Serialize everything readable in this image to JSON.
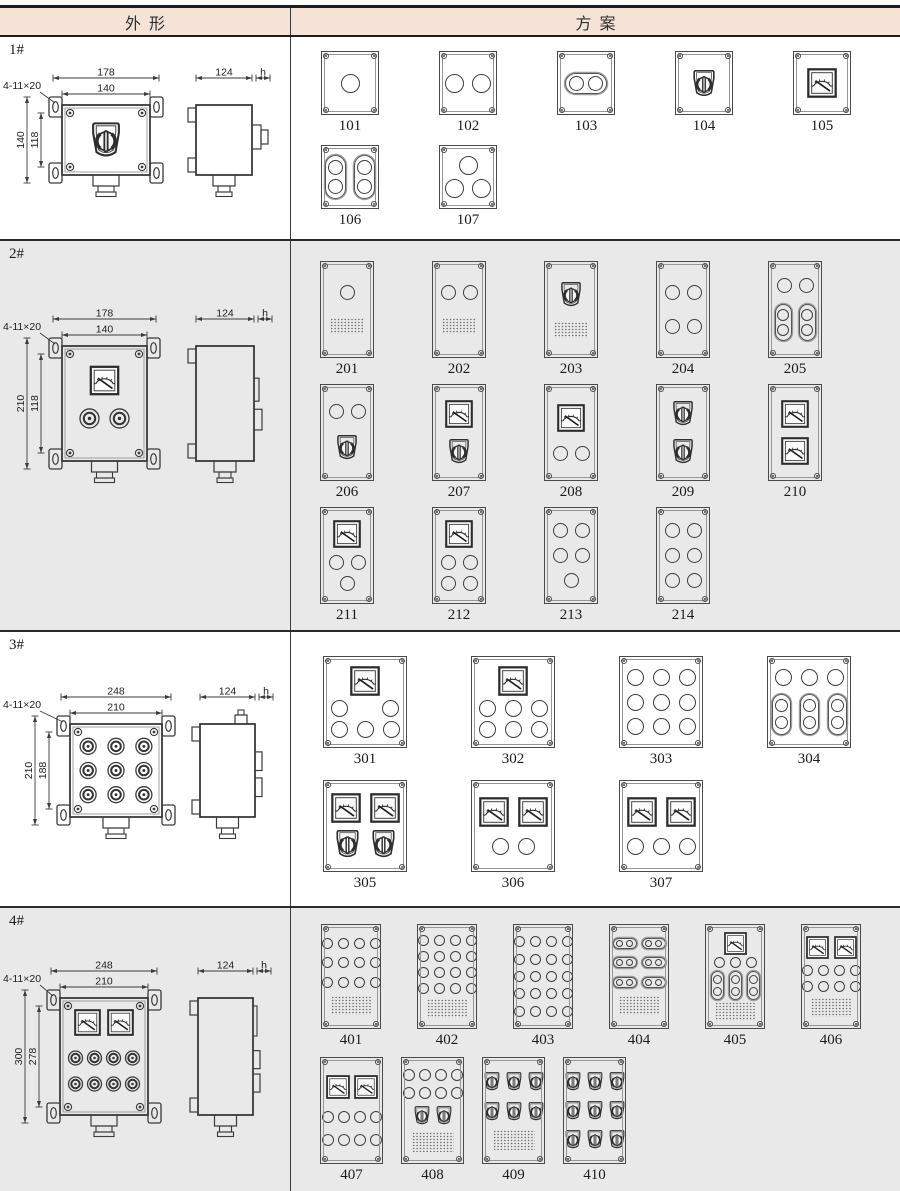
{
  "header": {
    "left": "外形",
    "right": "方案"
  },
  "colors": {
    "header_bg": "#f6e3d7",
    "alt_row_bg": "#e9e9e9",
    "line": "#3a3a3a"
  },
  "rows": [
    {
      "label": "1#",
      "alt": false,
      "pad_top": 14,
      "outline": {
        "mount": "4-11×20",
        "top_outer": "178",
        "top_inner": "140",
        "left_outer": "140",
        "left_inner": "118",
        "side_w": "124",
        "side_h": "h",
        "front": "switch"
      },
      "geom": {
        "svg_h": 200,
        "fx": 62,
        "fy": 68,
        "fw": 88,
        "fh": 70,
        "sx": 196,
        "sw": 56
      },
      "subrows": [
        {
          "cfg": "r1",
          "panels": [
            {
              "id": "101",
              "c": [
                [
                  "b"
                ]
              ]
            },
            {
              "id": "102",
              "c": [
                [
                  "b",
                  "b"
                ]
              ]
            },
            {
              "id": "103",
              "c": [
                [
                  "hh"
                ]
              ]
            },
            {
              "id": "104",
              "c": [
                [
                  "s"
                ]
              ]
            },
            {
              "id": "105",
              "c": [
                [
                  "m"
                ]
              ]
            }
          ]
        },
        {
          "cfg": "r1",
          "panels": [
            {
              "id": "106",
              "c": [
                [
                  "v",
                  "v"
                ]
              ]
            },
            {
              "id": "107",
              "c": [
                [
                  "b"
                ],
                [
                  "b",
                  "b"
                ]
              ]
            }
          ]
        }
      ]
    },
    {
      "label": "2#",
      "alt": true,
      "pad_top": 20,
      "outline": {
        "mount": "4-11×20",
        "top_outer": "178",
        "top_inner": "140",
        "left_outer": "210",
        "left_inner": "118",
        "side_w": "124",
        "side_h": "h",
        "front": "meter2btn"
      },
      "geom": {
        "svg_h": 387,
        "fx": 62,
        "fy": 105,
        "fw": 85,
        "fh": 115,
        "sx": 196,
        "sw": 58
      },
      "subrows": [
        {
          "cfg": "r2",
          "panels": [
            {
              "id": "201",
              "c": [
                [
                  "b"
                ],
                [
                  "ht"
                ]
              ]
            },
            {
              "id": "202",
              "c": [
                [
                  "b",
                  "b"
                ],
                [
                  "ht"
                ]
              ]
            },
            {
              "id": "203",
              "c": [
                [
                  "s"
                ],
                [
                  "ht"
                ]
              ]
            },
            {
              "id": "204",
              "c": [
                [
                  "b",
                  "b"
                ],
                [
                  "b",
                  "b"
                ]
              ]
            },
            {
              "id": "205",
              "c": [
                [
                  "b",
                  "b"
                ],
                [
                  "v",
                  "v"
                ]
              ]
            }
          ]
        },
        {
          "cfg": "r2",
          "panels": [
            {
              "id": "206",
              "c": [
                [
                  "b",
                  "b"
                ],
                [
                  "s"
                ]
              ]
            },
            {
              "id": "207",
              "c": [
                [
                  "m"
                ],
                [
                  "s"
                ]
              ]
            },
            {
              "id": "208",
              "c": [
                [
                  "m"
                ],
                [
                  "b",
                  "b"
                ]
              ]
            },
            {
              "id": "209",
              "c": [
                [
                  "s"
                ],
                [
                  "s"
                ]
              ]
            },
            {
              "id": "210",
              "c": [
                [
                  "m"
                ],
                [
                  "m"
                ]
              ]
            }
          ]
        },
        {
          "cfg": "r2",
          "panels": [
            {
              "id": "211",
              "c": [
                [
                  "m"
                ],
                [
                  "b",
                  "b"
                ],
                [
                  "b"
                ]
              ]
            },
            {
              "id": "212",
              "c": [
                [
                  "m"
                ],
                [
                  "b",
                  "b"
                ],
                [
                  "b",
                  "b"
                ]
              ]
            },
            {
              "id": "213",
              "c": [
                [
                  "b",
                  "b"
                ],
                [
                  "b",
                  "b"
                ],
                [
                  "b"
                ]
              ]
            },
            {
              "id": "214",
              "c": [
                [
                  "b",
                  "b"
                ],
                [
                  "b",
                  "b"
                ],
                [
                  "b",
                  "b"
                ]
              ]
            }
          ]
        }
      ]
    },
    {
      "label": "3#",
      "alt": false,
      "pad_top": 24,
      "outline": {
        "mount": "4-11×20",
        "top_outer": "248",
        "top_inner": "210",
        "left_outer": "210",
        "left_inner": "188",
        "side_w": "124",
        "side_h": "h",
        "front": "grid9"
      },
      "geom": {
        "svg_h": 274,
        "fx": 70,
        "fy": 92,
        "fw": 92,
        "fh": 93,
        "sx": 200,
        "sw": 55
      },
      "subrows": [
        {
          "cfg": "r3",
          "panels": [
            {
              "id": "301",
              "c": [
                [
                  "m"
                ],
                [
                  "b",
                  "g",
                  "b"
                ],
                [
                  "b",
                  "b",
                  "b"
                ]
              ]
            },
            {
              "id": "302",
              "c": [
                [
                  "m"
                ],
                [
                  "b",
                  "b",
                  "b"
                ],
                [
                  "b",
                  "b",
                  "b"
                ]
              ]
            },
            {
              "id": "303",
              "c": [
                [
                  "b",
                  "b",
                  "b"
                ],
                [
                  "b",
                  "b",
                  "b"
                ],
                [
                  "b",
                  "b",
                  "b"
                ]
              ]
            },
            {
              "id": "304",
              "c": [
                [
                  "b",
                  "b",
                  "b"
                ],
                [
                  "v",
                  "v",
                  "v"
                ]
              ]
            }
          ]
        },
        {
          "cfg": "r3",
          "panels": [
            {
              "id": "305",
              "c": [
                [
                  "m",
                  "m"
                ],
                [
                  "s",
                  "s"
                ]
              ]
            },
            {
              "id": "306",
              "c": [
                [
                  "m",
                  "m"
                ],
                [
                  "b",
                  "b"
                ]
              ]
            },
            {
              "id": "307",
              "c": [
                [
                  "m",
                  "m"
                ],
                [
                  "b",
                  "b",
                  "b"
                ]
              ]
            }
          ]
        }
      ]
    },
    {
      "label": "4#",
      "alt": true,
      "pad_top": 16,
      "outline": {
        "mount": "4-11×20",
        "top_outer": "248",
        "top_inner": "210",
        "left_outer": "300",
        "left_inner": "278",
        "side_w": "124",
        "side_h": "h",
        "front": "meter8btn"
      },
      "geom": {
        "svg_h": 283,
        "fx": 60,
        "fy": 90,
        "fw": 88,
        "fh": 117,
        "sx": 198,
        "sw": 55
      },
      "subrows": [
        {
          "cfg": "r4a",
          "panels": [
            {
              "id": "401",
              "c": [
                [
                  "b",
                  "b",
                  "b",
                  "b"
                ],
                [
                  "b",
                  "b",
                  "b",
                  "b"
                ],
                [
                  "b",
                  "b",
                  "b",
                  "b"
                ],
                [
                  "ht"
                ]
              ]
            },
            {
              "id": "402",
              "c": [
                [
                  "b",
                  "b",
                  "b",
                  "b"
                ],
                [
                  "b",
                  "b",
                  "b",
                  "b"
                ],
                [
                  "b",
                  "b",
                  "b",
                  "b"
                ],
                [
                  "b",
                  "b",
                  "b",
                  "b"
                ],
                [
                  "ht"
                ]
              ]
            },
            {
              "id": "403",
              "c": [
                [
                  "b",
                  "b",
                  "b",
                  "b"
                ],
                [
                  "b",
                  "b",
                  "b",
                  "b"
                ],
                [
                  "b",
                  "b",
                  "b",
                  "b"
                ],
                [
                  "b",
                  "b",
                  "b",
                  "b"
                ],
                [
                  "b",
                  "b",
                  "b",
                  "b"
                ]
              ]
            },
            {
              "id": "404",
              "c": [
                [
                  "hh",
                  "hh"
                ],
                [
                  "hh",
                  "hh"
                ],
                [
                  "hh",
                  "hh"
                ],
                [
                  "ht"
                ]
              ]
            },
            {
              "id": "405",
              "c": [
                [
                  "m"
                ],
                [
                  "b",
                  "b",
                  "b"
                ],
                [
                  "v",
                  "v",
                  "v"
                ],
                [
                  "ht"
                ]
              ]
            },
            {
              "id": "406",
              "c": [
                [
                  "m",
                  "m"
                ],
                [
                  "b",
                  "b",
                  "b",
                  "b"
                ],
                [
                  "b",
                  "b",
                  "b",
                  "b"
                ],
                [
                  "ht"
                ]
              ]
            }
          ]
        },
        {
          "cfg": "r4b",
          "panels": [
            {
              "id": "407",
              "c": [
                [
                  "m",
                  "m"
                ],
                [
                  "b",
                  "b",
                  "b",
                  "b"
                ],
                [
                  "b",
                  "b",
                  "b",
                  "b"
                ]
              ]
            },
            {
              "id": "408",
              "c": [
                [
                  "b",
                  "b",
                  "b",
                  "b"
                ],
                [
                  "b",
                  "b",
                  "b",
                  "b"
                ],
                [
                  "s",
                  "s"
                ],
                [
                  "ht"
                ]
              ]
            },
            {
              "id": "409",
              "c": [
                [
                  "s",
                  "s",
                  "s"
                ],
                [
                  "s",
                  "s",
                  "s"
                ],
                [
                  "ht"
                ]
              ]
            },
            {
              "id": "410",
              "c": [
                [
                  "s",
                  "s",
                  "s"
                ],
                [
                  "s",
                  "s",
                  "s"
                ],
                [
                  "s",
                  "s",
                  "s"
                ]
              ]
            }
          ]
        }
      ]
    }
  ],
  "cfgs": {
    "r1": {
      "pw": 58,
      "ph": 64,
      "slot": 118,
      "padLeft": 0,
      "mb": 10,
      "btn": 19,
      "mt": 30,
      "sw": [
        26,
        29
      ],
      "vt": [
        21,
        44,
        15
      ],
      "hh": [
        42,
        21,
        15
      ],
      "ht": [
        34,
        16
      ],
      "colGap": 8
    },
    "r2": {
      "pw": 54,
      "ph": 97,
      "slot": 112,
      "padLeft": 0,
      "mb": 6,
      "btn": 15,
      "mt": 28,
      "sw": [
        24,
        27
      ],
      "vt": [
        17,
        37,
        12
      ],
      "hh": [
        34,
        16,
        11
      ],
      "ht": [
        34,
        16
      ],
      "colGap": 7
    },
    "r3": {
      "pw": 84,
      "ph": 92,
      "slot": 148,
      "padLeft": 0,
      "mb": 12,
      "btn": 17,
      "mt": 30,
      "sw": [
        27,
        30
      ],
      "vt": [
        19,
        41,
        13
      ],
      "hh": [
        38,
        18,
        13
      ],
      "ht": [
        40,
        18
      ],
      "colGap": 9
    },
    "r4a": {
      "pw": 60,
      "ph": 105,
      "slot": 96,
      "padLeft": 12,
      "mb": 8,
      "btn": 11,
      "mt": 23,
      "sw": [
        20,
        23
      ],
      "vt": [
        13,
        29,
        9
      ],
      "hh": [
        24,
        11,
        7
      ],
      "ht": [
        40,
        19
      ],
      "colGap": 5
    },
    "r4b": {
      "pw": 63,
      "ph": 107,
      "slot": 81,
      "padLeft": 20,
      "mb": 8,
      "btn": 12,
      "mt": 24,
      "sw": [
        18,
        21
      ],
      "vt": [
        14,
        30,
        9
      ],
      "hh": [
        26,
        12,
        8
      ],
      "ht": [
        42,
        20
      ],
      "colGap": 4
    }
  }
}
